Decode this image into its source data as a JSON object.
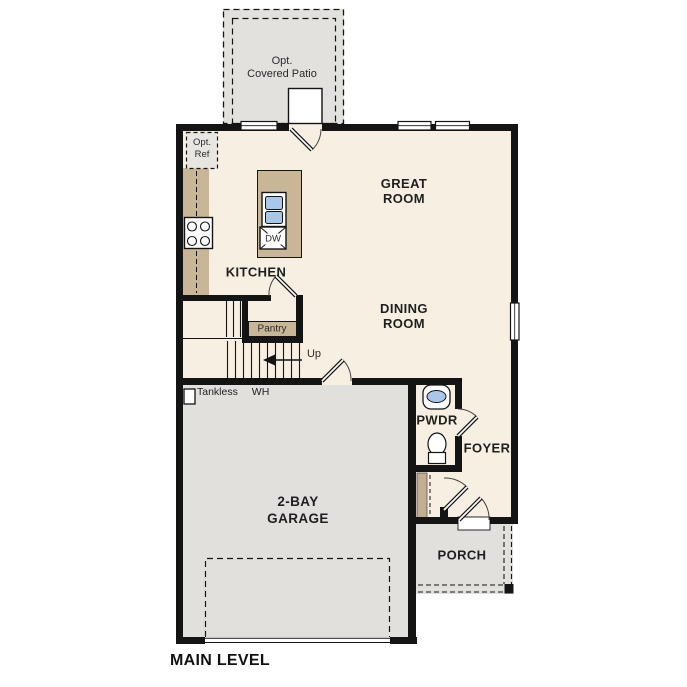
{
  "plan_title": "MAIN LEVEL",
  "rooms": {
    "patio": {
      "line1": "Opt.",
      "line2": "Covered Patio"
    },
    "great_room": {
      "line1": "GREAT",
      "line2": "ROOM"
    },
    "dining_room": {
      "line1": "DINING",
      "line2": "ROOM"
    },
    "kitchen": {
      "label": "KITCHEN"
    },
    "pantry": {
      "label": "Pantry"
    },
    "pwdr": {
      "label": "PWDR"
    },
    "foyer": {
      "label": "FOYER"
    },
    "garage": {
      "line1": "2-BAY",
      "line2": "GARAGE"
    },
    "porch": {
      "label": "PORCH"
    }
  },
  "annotations": {
    "opt_ref": {
      "line1": "Opt.",
      "line2": "Ref"
    },
    "dishwasher": {
      "label": "DW"
    },
    "tankless_wh": {
      "line1": "Tankless",
      "line2": "WH"
    },
    "stairs": {
      "label": "Up"
    }
  },
  "colors": {
    "floor": "#f7efe2",
    "outdoor_concrete": "#e2e1dd",
    "cabinetry": "#c9b696",
    "closet_shelf": "#c2ad90",
    "plumbing_blue": "#a9c7e9",
    "wall": "#141414"
  }
}
